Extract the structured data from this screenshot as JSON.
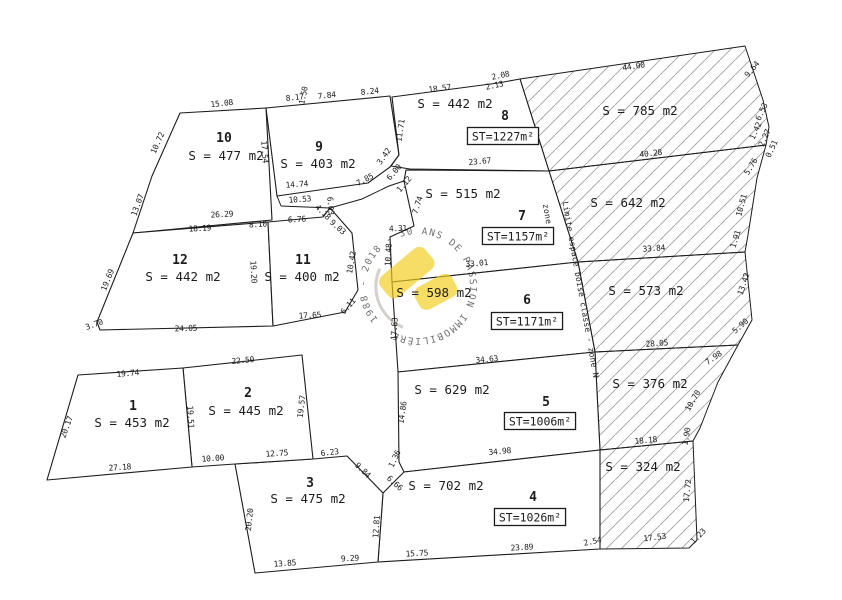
{
  "plan": {
    "canvas": {
      "width": 842,
      "height": 600,
      "background": "#ffffff",
      "line_color": "#1c1c1c",
      "hatch_color": "#a0a0a0"
    },
    "parcels": [
      {
        "id": "10",
        "number": "10",
        "area": "S = 477 m2",
        "points": [
          [
            180,
            113
          ],
          [
            266,
            108
          ],
          [
            272,
            220
          ],
          [
            133,
            233
          ],
          [
            152,
            176
          ]
        ],
        "number_xy": [
          224,
          142
        ],
        "area_xy": [
          226,
          160
        ]
      },
      {
        "id": "9",
        "number": "9",
        "area": "S = 403 m2",
        "points": [
          [
            266,
            108
          ],
          [
            390,
            96
          ],
          [
            399,
            155
          ],
          [
            390,
            167
          ],
          [
            368,
            183
          ],
          [
            277,
            196
          ]
        ],
        "number_xy": [
          319,
          151
        ],
        "area_xy": [
          318,
          168
        ]
      },
      {
        "id": "12",
        "number": "12",
        "area": "S = 442 m2",
        "points": [
          [
            133,
            233
          ],
          [
            268,
            222
          ],
          [
            273,
            326
          ],
          [
            100,
            330
          ],
          [
            97,
            322
          ]
        ],
        "number_xy": [
          180,
          264
        ],
        "area_xy": [
          183,
          281
        ]
      },
      {
        "id": "11",
        "number": "11",
        "area": "S = 400 m2",
        "points": [
          [
            268,
            222
          ],
          [
            323,
            217
          ],
          [
            330,
            208
          ],
          [
            352,
            233
          ],
          [
            358,
            290
          ],
          [
            345,
            312
          ],
          [
            273,
            326
          ]
        ],
        "number_xy": [
          303,
          264
        ],
        "area_xy": [
          302,
          281
        ]
      },
      {
        "id": "8",
        "number": "8",
        "area": "S = 442 m2",
        "st": "ST=1227m²",
        "points": [
          [
            392,
            97
          ],
          [
            498,
            83
          ],
          [
            520,
            79
          ],
          [
            549,
            171
          ],
          [
            410,
            169
          ],
          [
            391,
            166
          ],
          [
            399,
            155
          ]
        ],
        "number_xy": [
          505,
          120
        ],
        "area_xy": [
          455,
          108
        ],
        "st_xy": [
          503,
          137
        ]
      },
      {
        "id": "7",
        "number": "7",
        "area": "S = 515 m2",
        "st": "ST=1157m²",
        "points": [
          [
            406,
            170
          ],
          [
            549,
            171
          ],
          [
            578,
            262
          ],
          [
            392,
            282
          ],
          [
            390,
            237
          ],
          [
            414,
            226
          ],
          [
            404,
            181
          ]
        ],
        "number_xy": [
          522,
          220
        ],
        "area_xy": [
          463,
          198
        ],
        "st_xy": [
          518,
          237
        ]
      },
      {
        "id": "6",
        "number": "6",
        "area": "S = 598 m2",
        "st": "ST=1171m²",
        "points": [
          [
            392,
            282
          ],
          [
            578,
            262
          ],
          [
            595,
            352
          ],
          [
            398,
            372
          ]
        ],
        "number_xy": [
          527,
          304
        ],
        "area_xy": [
          434,
          297
        ],
        "st_xy": [
          527,
          322
        ]
      },
      {
        "id": "5",
        "number": "5",
        "area": "S = 629 m2",
        "st": "ST=1006m²",
        "points": [
          [
            398,
            372
          ],
          [
            595,
            352
          ],
          [
            600,
            450
          ],
          [
            404,
            472
          ],
          [
            399,
            462
          ]
        ],
        "number_xy": [
          546,
          406
        ],
        "area_xy": [
          452,
          394
        ],
        "st_xy": [
          540,
          422
        ]
      },
      {
        "id": "4",
        "number": "4",
        "area": "S = 702 m2",
        "st": "ST=1026m²",
        "points": [
          [
            404,
            472
          ],
          [
            600,
            450
          ],
          [
            600,
            549
          ],
          [
            378,
            562
          ],
          [
            383,
            493
          ]
        ],
        "number_xy": [
          533,
          501
        ],
        "area_xy": [
          446,
          490
        ],
        "st_xy": [
          530,
          518
        ]
      },
      {
        "id": "3",
        "number": "3",
        "area": "S = 475 m2",
        "points": [
          [
            235,
            464
          ],
          [
            313,
            459
          ],
          [
            347,
            456
          ],
          [
            383,
            493
          ],
          [
            378,
            562
          ],
          [
            255,
            573
          ]
        ],
        "number_xy": [
          310,
          487
        ],
        "area_xy": [
          308,
          503
        ]
      },
      {
        "id": "2",
        "number": "2",
        "area": "S = 445 m2",
        "points": [
          [
            183,
            368
          ],
          [
            302,
            355
          ],
          [
            313,
            459
          ],
          [
            235,
            464
          ],
          [
            192,
            467
          ]
        ],
        "number_xy": [
          248,
          397
        ],
        "area_xy": [
          246,
          415
        ]
      },
      {
        "id": "1",
        "number": "1",
        "area": "S = 453 m2",
        "points": [
          [
            78,
            375
          ],
          [
            183,
            368
          ],
          [
            192,
            467
          ],
          [
            47,
            480
          ]
        ],
        "number_xy": [
          133,
          410
        ],
        "area_xy": [
          132,
          427
        ]
      }
    ],
    "hatched_zones": [
      {
        "area": "S = 785 m2",
        "points": [
          [
            520,
            79
          ],
          [
            745,
            46
          ],
          [
            763,
            100
          ],
          [
            769,
            127
          ],
          [
            766,
            145
          ],
          [
            549,
            171
          ]
        ],
        "label_xy": [
          640,
          115
        ]
      },
      {
        "area": "S = 642 m2",
        "points": [
          [
            549,
            171
          ],
          [
            766,
            145
          ],
          [
            757,
            178
          ],
          [
            748,
            235
          ],
          [
            745,
            252
          ],
          [
            578,
            262
          ]
        ],
        "label_xy": [
          628,
          207
        ]
      },
      {
        "area": "S = 573 m2",
        "points": [
          [
            578,
            262
          ],
          [
            745,
            252
          ],
          [
            752,
            320
          ],
          [
            738,
            345
          ],
          [
            595,
            352
          ]
        ],
        "label_xy": [
          646,
          295
        ]
      },
      {
        "area": "S = 376 m2",
        "points": [
          [
            595,
            352
          ],
          [
            738,
            345
          ],
          [
            718,
            382
          ],
          [
            700,
            428
          ],
          [
            693,
            441
          ],
          [
            600,
            450
          ]
        ],
        "label_xy": [
          650,
          388
        ]
      },
      {
        "area": "S = 324 m2",
        "points": [
          [
            600,
            450
          ],
          [
            693,
            441
          ],
          [
            697,
            540
          ],
          [
            689,
            548
          ],
          [
            600,
            549
          ]
        ],
        "label_xy": [
          643,
          471
        ]
      }
    ],
    "corridor_lines": [
      {
        "points": [
          [
            277,
            196
          ],
          [
            281,
            206
          ]
        ]
      },
      {
        "points": [
          [
            281,
            206
          ],
          [
            330,
            208
          ],
          [
            362,
            199
          ],
          [
            389,
            186
          ],
          [
            404,
            181
          ]
        ]
      }
    ],
    "boundary_texts": [
      {
        "text": "zone Um",
        "x": 546,
        "y": 222,
        "r": 80
      },
      {
        "text": "Limite espace boisé classé - zone N",
        "x": 578,
        "y": 290,
        "r": 80
      }
    ],
    "dimensions": [
      [
        "15.08",
        222,
        106,
        -6
      ],
      [
        "10.72",
        160,
        144,
        -66
      ],
      [
        "13.07",
        140,
        206,
        -70
      ],
      [
        "17.54",
        262,
        152,
        86
      ],
      [
        "8.17",
        295,
        100,
        -6
      ],
      [
        "1.50",
        306,
        96,
        -78
      ],
      [
        "7.84",
        327,
        98,
        -6
      ],
      [
        "8.24",
        370,
        94,
        -6
      ],
      [
        "14.74",
        297,
        187,
        -4
      ],
      [
        "10.53",
        300,
        202,
        -4
      ],
      [
        "7.85",
        366,
        182,
        -28
      ],
      [
        "3.42",
        386,
        158,
        -55
      ],
      [
        "6.00",
        396,
        174,
        -50
      ],
      [
        "1.12",
        406,
        186,
        -50
      ],
      [
        "26.29",
        222,
        217,
        -3
      ],
      [
        "18.19",
        200,
        231,
        -3
      ],
      [
        "8.10",
        258,
        227,
        -3
      ],
      [
        "6.76",
        297,
        222,
        -3
      ],
      [
        "6.03",
        328,
        206,
        85
      ],
      [
        "4.18",
        321,
        214,
        45
      ],
      [
        "9.03",
        336,
        229,
        42
      ],
      [
        "19.20",
        251,
        272,
        87
      ],
      [
        "10.42",
        354,
        263,
        -80
      ],
      [
        "6.11",
        350,
        308,
        -48
      ],
      [
        "19.69",
        110,
        281,
        -68
      ],
      [
        "3.70",
        95,
        327,
        -20
      ],
      [
        "24.05",
        186,
        331,
        -2
      ],
      [
        "17.65",
        310,
        318,
        -3
      ],
      [
        "18.57",
        440,
        91,
        -7
      ],
      [
        "2.08",
        501,
        78,
        -12
      ],
      [
        "2.13",
        495,
        88,
        -12
      ],
      [
        "11.71",
        403,
        131,
        -82
      ],
      [
        "23.67",
        480,
        164,
        -5
      ],
      [
        "7.74",
        420,
        206,
        -72
      ],
      [
        "4.31",
        398,
        231,
        -2
      ],
      [
        "10.48",
        391,
        255,
        -87
      ],
      [
        "33.01",
        477,
        266,
        -5
      ],
      [
        "17.63",
        397,
        329,
        -87
      ],
      [
        "34.63",
        487,
        362,
        -5
      ],
      [
        "14.86",
        405,
        413,
        -82
      ],
      [
        "34.98",
        500,
        454,
        -5
      ],
      [
        "1.36",
        397,
        460,
        -65
      ],
      [
        "6.66",
        393,
        485,
        42
      ],
      [
        "12.81",
        379,
        527,
        -86
      ],
      [
        "15.75",
        417,
        556,
        -3
      ],
      [
        "9.29",
        350,
        561,
        -3
      ],
      [
        "13.85",
        285,
        566,
        -4
      ],
      [
        "20.20",
        252,
        520,
        -84
      ],
      [
        "6.23",
        330,
        455,
        -7
      ],
      [
        "9.84",
        361,
        472,
        43
      ],
      [
        "12.75",
        277,
        456,
        -4
      ],
      [
        "10.00",
        213,
        461,
        -4
      ],
      [
        "19.57",
        304,
        407,
        -83
      ],
      [
        "22.50",
        243,
        363,
        -5
      ],
      [
        "19.51",
        188,
        417,
        87
      ],
      [
        "19.74",
        128,
        376,
        -5
      ],
      [
        "20.17",
        69,
        428,
        -70
      ],
      [
        "27.18",
        120,
        470,
        -4
      ],
      [
        "23.89",
        522,
        550,
        -3
      ],
      [
        "2.54",
        593,
        544,
        -12
      ],
      [
        "17.53",
        655,
        540,
        -7
      ],
      [
        "18.18",
        646,
        443,
        -5
      ],
      [
        "1.90",
        689,
        437,
        -80
      ],
      [
        "10.70",
        695,
        402,
        -60
      ],
      [
        "7.98",
        715,
        360,
        -35
      ],
      [
        "28.05",
        657,
        346,
        -4
      ],
      [
        "33.84",
        654,
        251,
        -4
      ],
      [
        "5.90",
        742,
        328,
        -42
      ],
      [
        "13.42",
        746,
        285,
        -72
      ],
      [
        "1.91",
        738,
        240,
        -72
      ],
      [
        "10.51",
        744,
        206,
        -75
      ],
      [
        "5.76",
        753,
        168,
        -58
      ],
      [
        "0.51",
        774,
        150,
        -65
      ],
      [
        "2.27",
        767,
        139,
        -65
      ],
      [
        "1.42",
        758,
        132,
        -65
      ],
      [
        "6.53",
        764,
        113,
        -65
      ],
      [
        "9.64",
        754,
        71,
        -50
      ],
      [
        "44.00",
        634,
        69,
        -9
      ],
      [
        "40.28",
        651,
        156,
        -6
      ],
      [
        "17.72",
        690,
        491,
        -84
      ],
      [
        "1.23",
        700,
        538,
        -45
      ]
    ],
    "watermark": {
      "ring_text": "1988 - 2018 - 30 ANS DE PASSION IMMOBILIÈRE",
      "cx": 418,
      "cy": 286,
      "radius": 52,
      "rotation": -40,
      "ring_color": "#a89f94",
      "accent_color": "#f2cd1e"
    }
  }
}
